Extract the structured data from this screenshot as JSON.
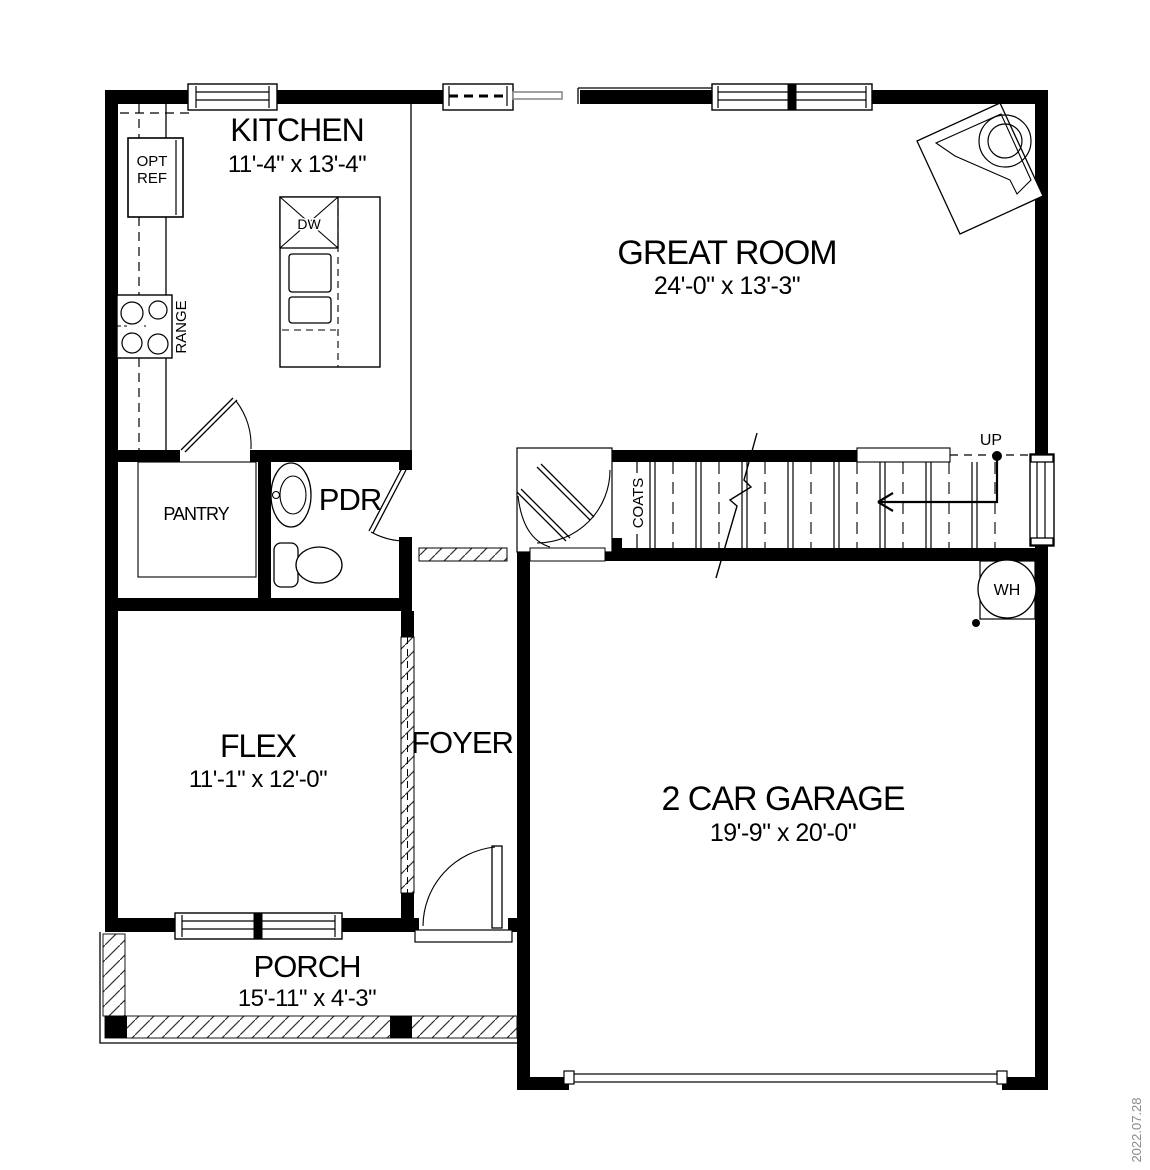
{
  "plan": {
    "date_stamp": "2022.07.28",
    "rooms": {
      "kitchen": {
        "name": "KITCHEN",
        "dims": "11'-4\" x 13'-4\""
      },
      "great_room": {
        "name": "GREAT ROOM",
        "dims": "24'-0\" x 13'-3\""
      },
      "flex": {
        "name": "FLEX",
        "dims": "11'-1\" x 12'-0\""
      },
      "foyer": {
        "name": "FOYER"
      },
      "garage": {
        "name": "2 CAR GARAGE",
        "dims": "19'-9\" x 20'-0\""
      },
      "porch": {
        "name": "PORCH",
        "dims": "15'-11\" x 4'-3\""
      },
      "pantry": {
        "name": "PANTRY"
      },
      "powder_room": {
        "name": "PDR"
      }
    },
    "fixtures": {
      "opt_ref_line1": "OPT",
      "opt_ref_line2": "REF",
      "range": "RANGE",
      "dishwasher": "DW",
      "water_heater": "WH",
      "coats_closet": "COATS",
      "stairs_up": "UP"
    },
    "colors": {
      "line": "#000000",
      "muted_gray": "#8a8a8a"
    }
  }
}
